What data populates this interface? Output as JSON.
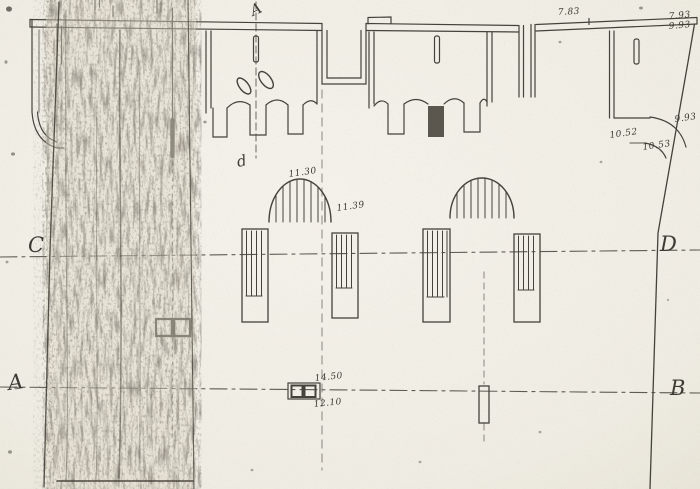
{
  "figure": {
    "kind": "scanned fortification plan drawing",
    "paper_color": "#f1eee6",
    "ink_color": "#45423b",
    "section_letters": {
      "top_axis": "A",
      "detail_small": "d",
      "left_upper": "C",
      "right_upper": "D",
      "left_lower": "A",
      "right_lower": "B"
    },
    "measurements": {
      "top_center": "7.83",
      "top_right_upper": "7.93",
      "top_right_lower": "9.93",
      "right_tower": "9.93",
      "right_arc_upper": "10.52",
      "right_arc_lower": "10.53",
      "arch_above": "11.30",
      "arch_right": "11.39",
      "base_above": "14.50",
      "base_below": "12.10"
    }
  }
}
